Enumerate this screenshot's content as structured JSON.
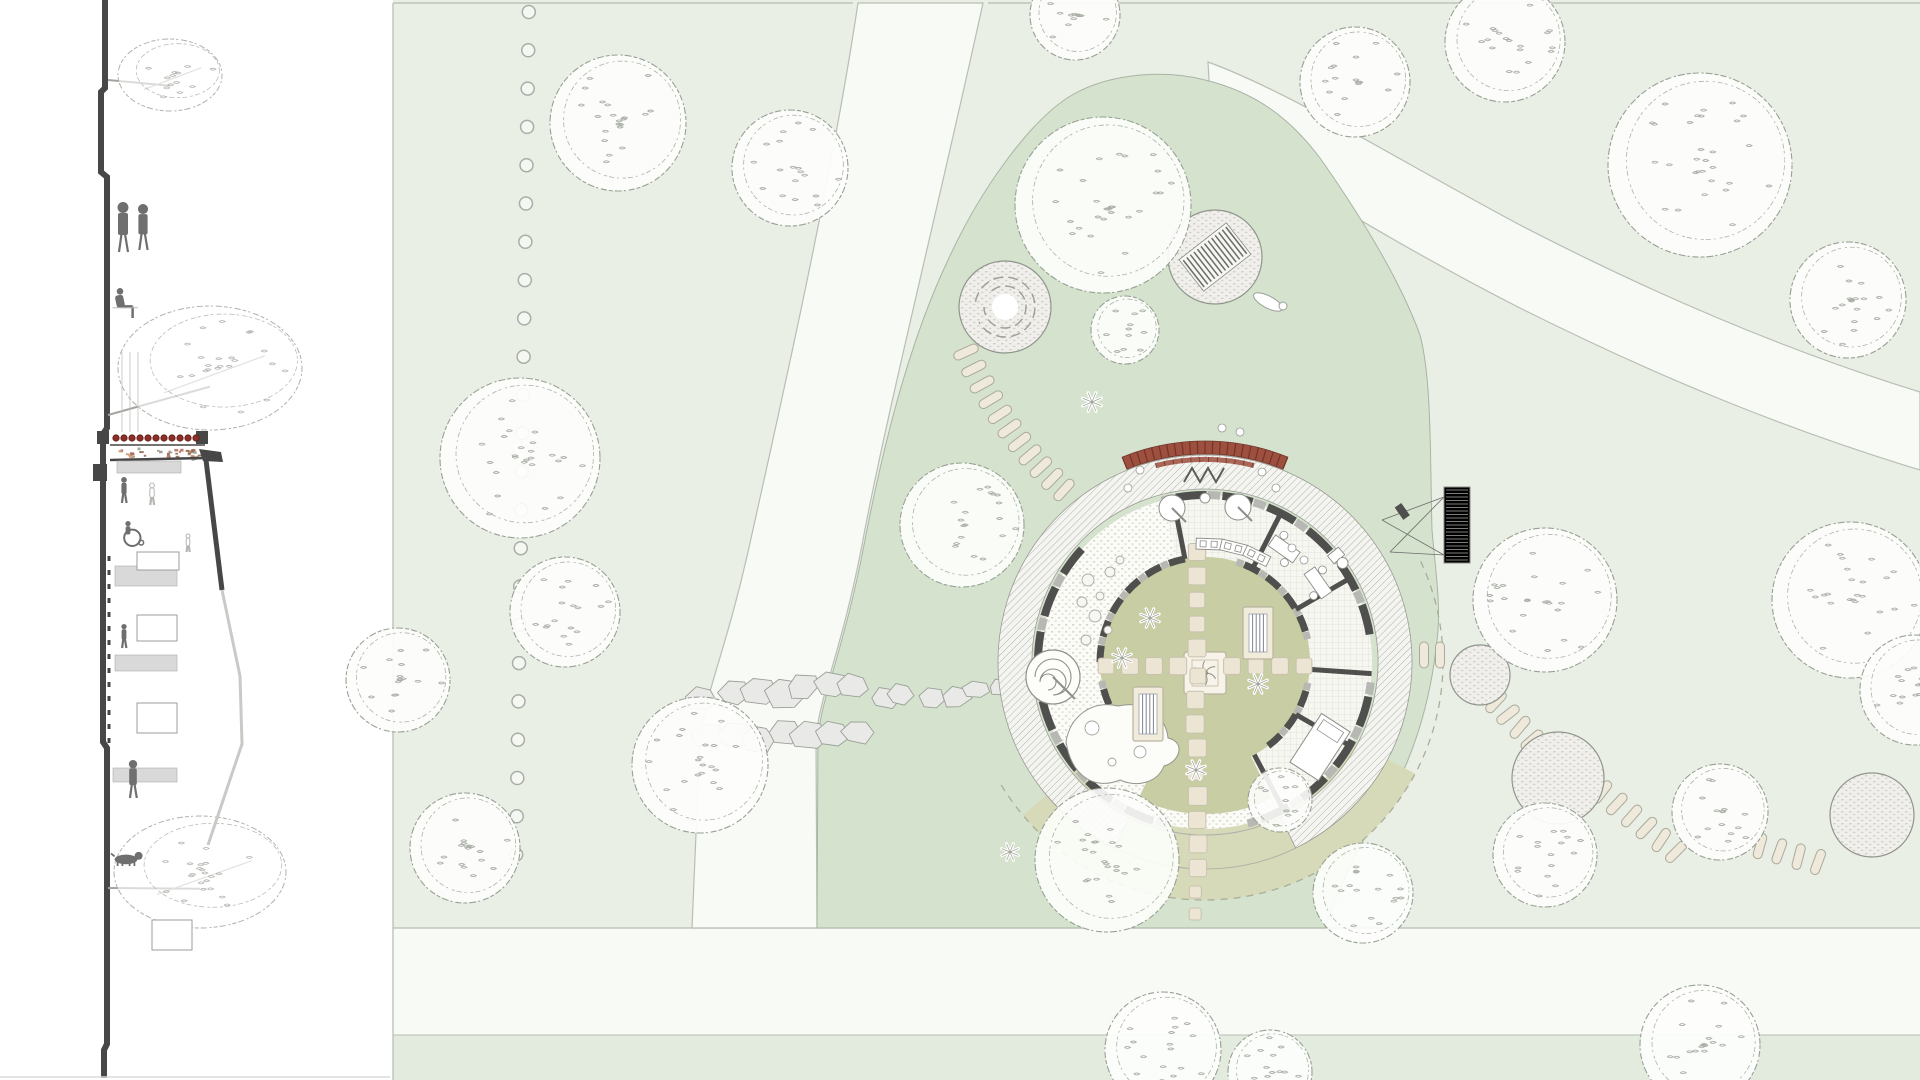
{
  "palette": {
    "field": "#e9efe4",
    "field_border": "#bdc3b8",
    "strip": "#e3ebde",
    "path": "#f8faf6",
    "path_edge": "#b9beb4",
    "garden": "#d5e3ce",
    "garden_edge": "#a9b3a4",
    "fan": "#d7dab9",
    "fan_edge": "#a9ae9b",
    "courtyard": "#c9cda3",
    "hatch_bg": "#f4f4f0",
    "hatch_ln": "#b2b2ac",
    "ring_bg": "#fbfbf7",
    "ring_dot": "#d7d7cb",
    "tile_bg": "#f7f7f2",
    "tile_ln": "#dedcd2",
    "wall_dark": "#4f4f4d",
    "wall_lite": "#b7b7b3",
    "awning": "#9e4f3e",
    "awning_dark": "#6e362b",
    "paver": "#ece5d4",
    "paver_edge": "#c8c2ae",
    "pill": "#eee9db",
    "pill_edge": "#aaa99b",
    "pad_bg": "#f0efeb",
    "pad_edge": "#8f958c",
    "tree_line": "#98a094",
    "tree_fill": "#fdfefc",
    "speckle": "#aab0a7",
    "stone": "#e9eae7",
    "stone_edge": "#9aa096",
    "sprite": "#ffffff",
    "sprite_edge": "#9aa096",
    "sec_dark": "#474747",
    "sec_fig": "#6f6f6f",
    "sec_ghost": "#b5b5b2",
    "sec_lite": "#d9d9d9",
    "sec_line": "#9c9c9c",
    "sec_edge": "#c9c9c6",
    "tile_red": "#8e2f27",
    "tile_red_edge": "#5f1f1a",
    "speck_colors": [
      "#b06a52",
      "#c49a7a",
      "#9a9a94",
      "#8e5e48"
    ]
  },
  "layout": {
    "w": 1920,
    "h": 1080,
    "plan_left": 393,
    "path_band": {
      "y": 928,
      "h": 107
    },
    "strip_y": 1035,
    "top_line_y": 3
  },
  "dotted_line": {
    "x": 529,
    "y0": 12,
    "step": 38.3,
    "count": 23,
    "r": 6.5
  },
  "paths": {
    "p1": "M858,3 L983,3 C940,200 885,420 862,545 C842,650 818,700 816,740 L817,928 L692,928 L700,740 C706,690 726,650 748,552 C775,430 830,190 858,3 Z",
    "p2": "M1208,62 C1290,92 1398,160 1520,225 C1665,300 1800,355 1920,392 L1920,470 C1788,430 1660,378 1520,308 C1390,242 1282,172 1212,132 Z"
  },
  "garden": {
    "outline": "M1205,80 C1255,92 1290,118 1320,158 C1360,215 1400,280 1420,335 C1432,380 1430,460 1432,530 C1436,575 1440,600 1438,630 C1432,700 1412,770 1372,826 C1352,858 1336,895 1325,928 L817,928 L818,740 C820,700 844,650 864,545 C888,420 915,330 948,260 C980,190 1030,120 1072,95 C1112,72 1168,70 1205,80 Z"
  },
  "flagstones": {
    "x0": 706,
    "y0": 712,
    "x1": 1004,
    "y1": 690,
    "rows": 2,
    "count": 13
  },
  "building": {
    "cx": 1205,
    "cy": 662,
    "r_court": 105,
    "r_inner_wall": 105,
    "r_outer_wall": 167,
    "r_hatch0": 173,
    "r_hatch1": 207,
    "r_dash": 238,
    "fan": {
      "a0": 28,
      "a1": 140
    },
    "dash_arc": {
      "a0": -25,
      "a1": 150
    },
    "tongue": {
      "a0": 64,
      "a1": 116,
      "r1": 152
    },
    "tile_sector": {
      "a0": -105,
      "a1": 66
    },
    "outer_gaps": [
      [
        -133,
        -113
      ],
      [
        -5,
        4
      ],
      [
        84,
        97
      ],
      [
        170,
        190
      ]
    ],
    "inner_gaps": [
      [
        -98,
        -81
      ],
      [
        -5,
        6
      ],
      [
        56,
        124
      ],
      [
        172,
        189
      ]
    ],
    "partitions": [
      -101,
      -63,
      -30,
      4,
      30,
      62
    ],
    "awning": {
      "a0": -112,
      "a1": -68,
      "r0": 208,
      "r1": 221,
      "band": {
        "a0": -104,
        "a1": -76,
        "r0": 200,
        "r1": 205
      }
    },
    "zigzag": [
      [
        1184,
        482
      ],
      [
        1192,
        468
      ],
      [
        1200,
        482
      ],
      [
        1208,
        468
      ],
      [
        1216,
        482
      ],
      [
        1224,
        468
      ]
    ],
    "spiral": {
      "x": 1053,
      "y": 677,
      "r": 27
    },
    "center_pad": {
      "x": 1184,
      "y": 652,
      "s": 42
    },
    "planters": [
      [
        1133,
        687,
        30,
        54
      ],
      [
        1243,
        607,
        30,
        52
      ]
    ],
    "arm_n": {
      "x": 1197,
      "ys": [
        552,
        576,
        600,
        624,
        648
      ]
    },
    "arm_s": {
      "x": 1197,
      "ys": [
        676,
        700,
        724,
        748,
        772,
        796,
        820,
        844,
        868,
        892,
        914
      ]
    },
    "arm_e": {
      "y": 666,
      "xs": [
        1232,
        1256,
        1280,
        1304
      ]
    },
    "arm_w": {
      "y": 666,
      "xs": [
        1106,
        1130,
        1154,
        1178
      ]
    },
    "court_sprites": [
      [
        1122,
        658
      ],
      [
        1258,
        684
      ],
      [
        1196,
        770
      ],
      [
        1150,
        618
      ],
      [
        1092,
        402
      ]
    ],
    "pebbles": [
      [
        1088,
        580,
        6
      ],
      [
        1100,
        596,
        4
      ],
      [
        1082,
        602,
        5
      ],
      [
        1095,
        616,
        6
      ],
      [
        1108,
        630,
        4
      ],
      [
        1086,
        640,
        5
      ],
      [
        1120,
        560,
        4
      ],
      [
        1110,
        572,
        5
      ]
    ],
    "round_tables": [
      [
        1172,
        508
      ],
      [
        1238,
        507
      ]
    ],
    "deco_circle": [
      1205,
      498,
      5
    ],
    "chair_dots": [
      [
        1262,
        472
      ],
      [
        1276,
        488
      ],
      [
        1292,
        548
      ],
      [
        1304,
        560
      ],
      [
        1240,
        432
      ],
      [
        1222,
        428
      ],
      [
        1140,
        470
      ],
      [
        1128,
        488
      ]
    ],
    "counters": [
      -88,
      -76,
      -64
    ],
    "tables": [
      -55,
      -35
    ],
    "bed": {
      "x": 1320,
      "y": 747,
      "w": 34,
      "h": 58,
      "rot": 33
    },
    "toilet": {
      "x": 1340,
      "y": 560,
      "rot": -40
    },
    "sand": "M1066,742 C1070,716 1092,700 1118,706 C1146,700 1166,716 1168,738 C1186,742 1180,762 1164,766 C1158,782 1138,788 1120,780 C1096,790 1072,778 1066,742 Z",
    "sand_circles": [
      [
        1092,
        728,
        7
      ],
      [
        1140,
        752,
        6
      ],
      [
        1112,
        762,
        4
      ]
    ],
    "deck": {
      "x": 1444,
      "y": 487,
      "w": 26,
      "h": 76,
      "anchors": [
        [
          1382,
          520
        ],
        [
          1390,
          552
        ]
      ]
    }
  },
  "chains": {
    "nw": {
      "p0": [
        1064,
        490
      ],
      "p1": [
        1004,
        436
      ],
      "p2": [
        966,
        352
      ],
      "n": 11
    },
    "eastA": {
      "from": [
        1496,
        702
      ],
      "to": [
        1532,
        740
      ],
      "n": 4
    },
    "eastB": {
      "from": [
        1602,
        792
      ],
      "to": [
        1676,
        852
      ],
      "n": 6
    },
    "eastC": {
      "from": [
        1760,
        846
      ],
      "to": [
        1818,
        862
      ],
      "n": 4
    }
  },
  "pads": {
    "ring_pad": {
      "x": 1005,
      "y": 307,
      "r": 46
    },
    "stripe_pad": {
      "x": 1215,
      "y": 257,
      "r": 47,
      "rot": -38
    },
    "east": [
      [
        1480,
        675,
        30
      ],
      [
        1558,
        778,
        46
      ],
      [
        1872,
        815,
        42
      ]
    ],
    "lying_figure": [
      1268,
      302
    ]
  },
  "trees_field": [
    [
      618,
      123,
      68
    ],
    [
      790,
      168,
      58
    ],
    [
      520,
      458,
      80
    ],
    [
      565,
      612,
      55
    ],
    [
      398,
      680,
      52
    ],
    [
      465,
      848,
      55
    ],
    [
      700,
      765,
      68
    ],
    [
      1075,
      15,
      45
    ],
    [
      1355,
      82,
      55
    ],
    [
      1505,
      42,
      60
    ],
    [
      1700,
      165,
      92
    ],
    [
      1848,
      300,
      58
    ],
    [
      1850,
      600,
      78
    ],
    [
      1545,
      600,
      72
    ],
    [
      1915,
      690,
      55
    ],
    [
      1545,
      855,
      52
    ],
    [
      1720,
      812,
      48
    ],
    [
      1163,
      1050,
      58
    ],
    [
      1700,
      1045,
      60
    ],
    [
      1270,
      1072,
      42
    ]
  ],
  "trees_garden": [
    [
      1103,
      205,
      88
    ],
    [
      962,
      525,
      62
    ],
    [
      1125,
      330,
      34
    ],
    [
      1107,
      860,
      72
    ],
    [
      1280,
      800,
      32
    ],
    [
      1363,
      893,
      50
    ]
  ],
  "section": {
    "ground": "M105,0 L105,88 L101,92 L101,172 L107,177 L107,428 L103,434 L103,742 L107,748 L107,1044 L104,1050 L104,1078",
    "tick_line": {
      "x": 109,
      "y0": 556,
      "y1": 744
    },
    "roof": {
      "tile_y": 438,
      "tile_x0": 116,
      "tile_n": 11,
      "tile_step": 8,
      "caps": [
        [
          97,
          431
        ],
        [
          196,
          431
        ]
      ],
      "speckle_band": [
        110,
        447,
        96,
        13
      ]
    },
    "dark_bits": {
      "stub": [
        93,
        464,
        14,
        17
      ],
      "wedge": "M199,449 L221,452 L223,462 L203,461 Z",
      "edge": [
        [
          205,
          452
        ],
        [
          222,
          590
        ]
      ],
      "ceil": [
        [
          110,
          460
        ],
        [
          205,
          458
        ]
      ]
    },
    "grey_edge": "M222,590 L240,676 L242,744 L208,845",
    "slabs": [
      [
        117,
        461,
        64,
        12
      ],
      [
        115,
        566,
        62,
        20
      ],
      [
        115,
        655,
        62,
        16
      ],
      [
        113,
        768,
        64,
        14
      ]
    ],
    "boxes": [
      [
        137,
        552,
        42,
        18
      ],
      [
        137,
        615,
        40,
        26
      ],
      [
        137,
        703,
        40,
        30
      ],
      [
        152,
        920,
        40,
        30
      ]
    ],
    "posts": [
      [
        122,
        352,
        432
      ],
      [
        130,
        352,
        432
      ],
      [
        138,
        352,
        432
      ]
    ],
    "trees": [
      {
        "cx": 170,
        "cy": 75,
        "rx": 52,
        "ry": 36,
        "ty": 80
      },
      {
        "cx": 210,
        "cy": 368,
        "rx": 92,
        "ry": 62,
        "ty": 415
      },
      {
        "cx": 200,
        "cy": 872,
        "rx": 86,
        "ry": 56,
        "ty": 888
      }
    ],
    "people": [
      {
        "t": "stand",
        "x": 123,
        "y": 252,
        "h": 50
      },
      {
        "t": "stand",
        "x": 143,
        "y": 250,
        "h": 46
      },
      {
        "t": "sit",
        "x": 120,
        "y": 318,
        "h": 30
      },
      {
        "t": "stand",
        "x": 124,
        "y": 503,
        "h": 26
      },
      {
        "t": "ghost",
        "x": 152,
        "y": 505,
        "h": 22
      },
      {
        "t": "wheel",
        "x": 128,
        "y": 545,
        "h": 24
      },
      {
        "t": "ghost",
        "x": 188,
        "y": 552,
        "h": 18
      },
      {
        "t": "stand",
        "x": 124,
        "y": 648,
        "h": 24
      },
      {
        "t": "stand",
        "x": 133,
        "y": 798,
        "h": 38
      },
      {
        "t": "dog",
        "x": 126,
        "y": 866,
        "h": 12
      }
    ],
    "bottom_line_y": 1077
  }
}
